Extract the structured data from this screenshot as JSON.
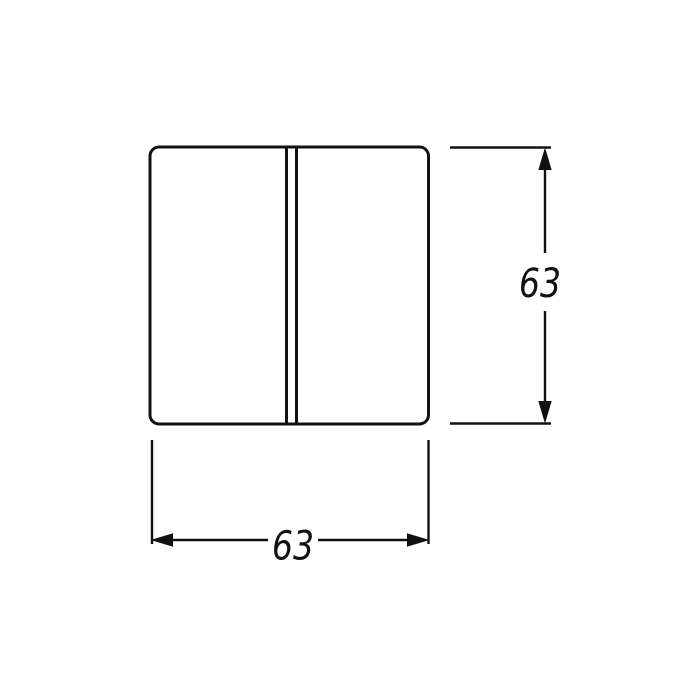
{
  "drawing": {
    "colors": {
      "background": "#ffffff",
      "line": "#111111"
    },
    "dimensions": {
      "height": {
        "label": "63"
      },
      "width": {
        "label": "63"
      }
    }
  }
}
